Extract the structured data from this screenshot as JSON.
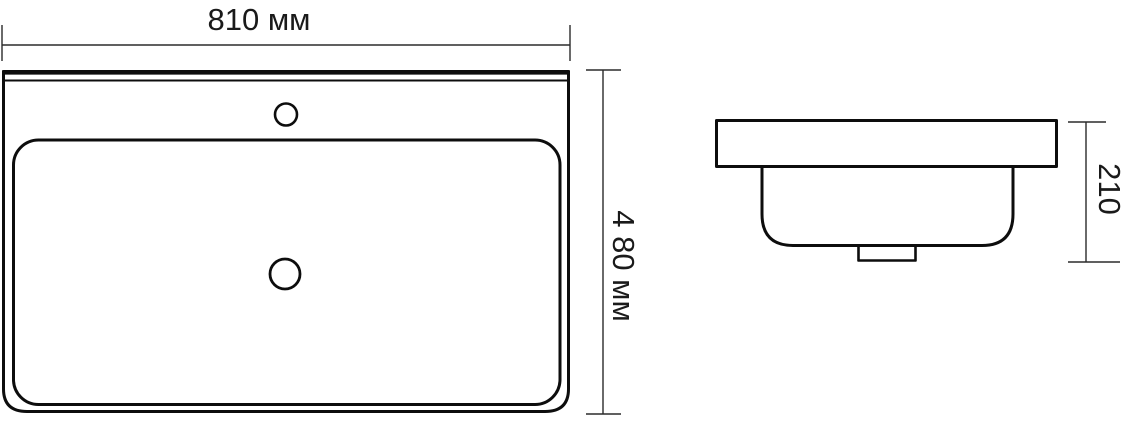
{
  "drawing": {
    "background_color": "#ffffff",
    "line_color": "#0d0d0d",
    "dimension_line_color": "#2b2b2b",
    "unit": "мм"
  },
  "top_view": {
    "name": "washbasin-plan-view",
    "width_dimension": {
      "label": "810 мм",
      "value_mm": 810
    },
    "depth_dimension": {
      "label": "4 80 мм",
      "value_mm": 480
    },
    "features": {
      "faucet_hole": "small circle, top center",
      "drain_hole": "circle, bowl center"
    }
  },
  "side_view": {
    "name": "washbasin-side-view",
    "height_dimension": {
      "label": "210",
      "value_mm": 210
    }
  }
}
